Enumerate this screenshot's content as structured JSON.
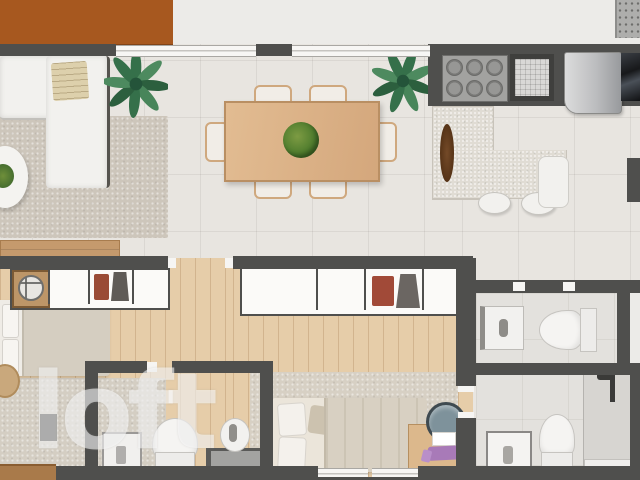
{
  "watermark": {
    "text": "loft"
  },
  "palette": {
    "wall": "#4f4f4d",
    "terrace_roof": "#a7581f",
    "exterior": "#ecebe8",
    "tile_floor": "#e8e5e0",
    "wood_floor": "#e6cda9",
    "rug": "#cdc6bb",
    "counter_island": "#e0dcd4",
    "sofa": "#f2f1ee",
    "dining_table": "#e2bc92",
    "plant_green": "#3d7a4f",
    "fridge_steel": "#c0c1c3",
    "garment_red": "#9a4b36",
    "desk_purple": "#a87ab8",
    "bed_blanket": "#d8d0c2"
  },
  "plan": {
    "rooms": [
      {
        "name": "living-room",
        "furniture": [
          "l-shaped-sofa",
          "throw-blanket",
          "round-coffee-table",
          "table-plant",
          "potted-plant",
          "rug",
          "tv-sideboard"
        ]
      },
      {
        "name": "dining-area",
        "furniture": [
          "dining-table",
          "chairs-x6",
          "centerpiece-plant",
          "potted-plant"
        ]
      },
      {
        "name": "kitchen",
        "furniture": [
          "cooktop-6-burners",
          "sink",
          "refrigerator",
          "oven",
          "l-shaped-island",
          "cutting-board",
          "stools-x2",
          "bench"
        ]
      },
      {
        "name": "bedroom-1",
        "furniture": [
          "closet-with-clothes",
          "round-fixture",
          "bed",
          "rug",
          "tv-rack",
          "pouf"
        ]
      },
      {
        "name": "bathroom-1",
        "furniture": [
          "shower-box",
          "toilet",
          "washbasin",
          "vanity-counter"
        ]
      },
      {
        "name": "master-bedroom",
        "furniture": [
          "closet-with-clothes",
          "double-bed",
          "rug",
          "desk",
          "office-chair",
          "desk-accessories"
        ]
      },
      {
        "name": "powder-room",
        "furniture": [
          "washbasin",
          "toilet"
        ]
      },
      {
        "name": "master-bathroom",
        "furniture": [
          "washbasin",
          "toilet",
          "shower",
          "shelf"
        ]
      }
    ],
    "outdoor": [
      "terrace-roof",
      "ac-unit"
    ]
  }
}
